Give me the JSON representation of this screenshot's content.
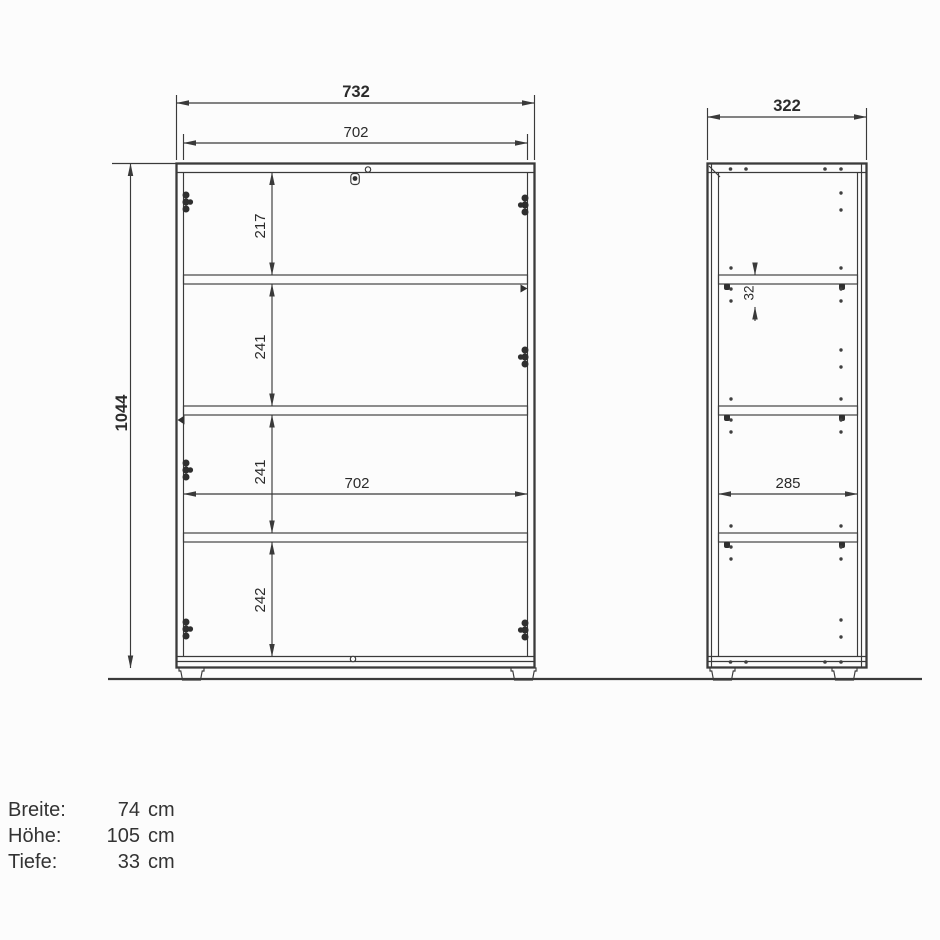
{
  "front": {
    "width_outer": "732",
    "width_inner": "702",
    "height": "1044",
    "sections": [
      "217",
      "241",
      "241",
      "242"
    ],
    "width_inner_mid": "702"
  },
  "side": {
    "depth_outer": "322",
    "hole_pitch": "32",
    "depth_inner": "285"
  },
  "specs": {
    "rows": [
      {
        "label": "Breite:",
        "value": "74",
        "unit": "cm"
      },
      {
        "label": "Höhe:",
        "value": "105",
        "unit": "cm"
      },
      {
        "label": "Tiefe:",
        "value": "33",
        "unit": "cm"
      }
    ]
  },
  "colors": {
    "line": "#3a3a3a",
    "text": "#2b2b2b",
    "spec_text": "#333333",
    "background": "#fcfcfc"
  }
}
